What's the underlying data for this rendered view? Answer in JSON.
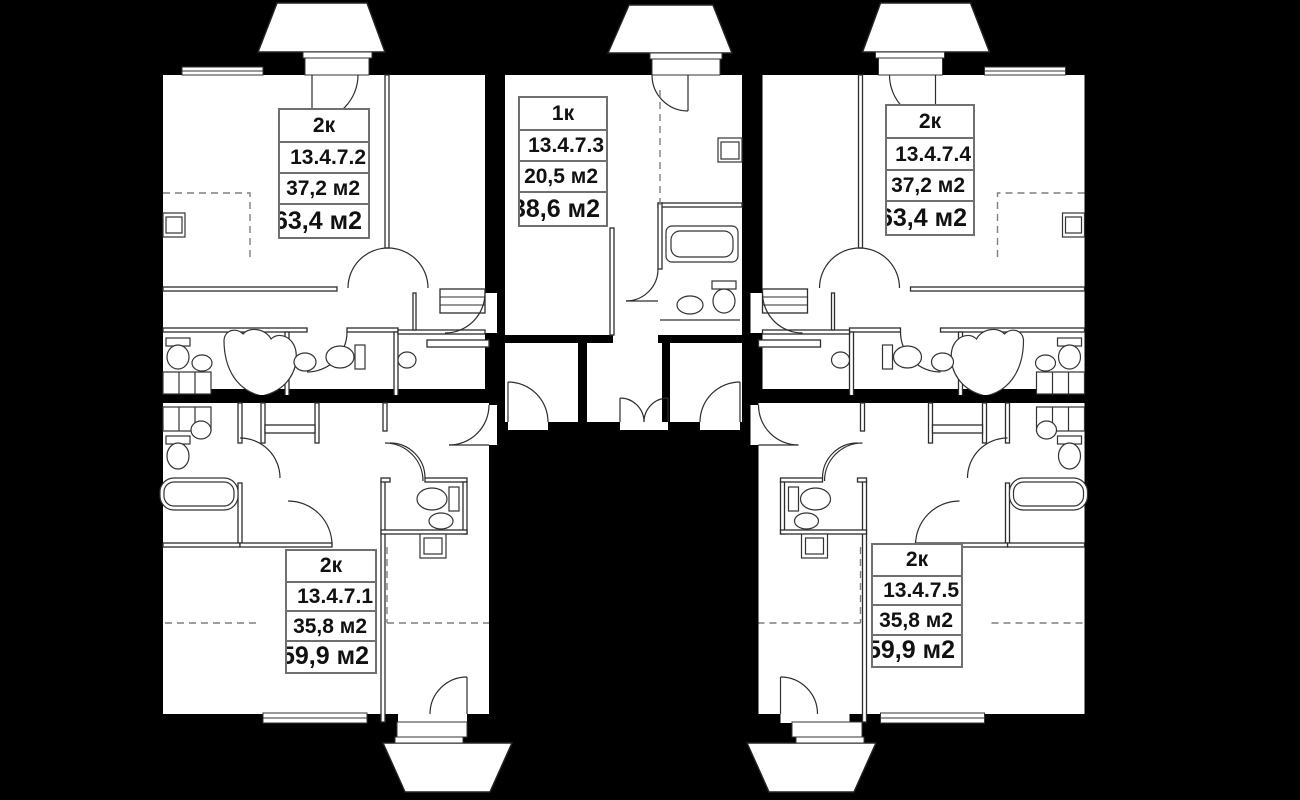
{
  "plan": {
    "colors": {
      "background": "#000000",
      "floor": "#ffffff",
      "line": "#2d2d2d",
      "dashed_line": "#7f7f7f",
      "card_border": "#707070"
    },
    "units": [
      {
        "rooms": "2к",
        "code": "13.4.7.1",
        "area_living": "35,8 м2",
        "area_total": "59,9 м2"
      },
      {
        "rooms": "2к",
        "code": "13.4.7.2",
        "area_living": "37,2 м2",
        "area_total": "63,4 м2"
      },
      {
        "rooms": "1к",
        "code": "13.4.7.3",
        "area_living": "20,5 м2",
        "area_total": "38,6 м2"
      },
      {
        "rooms": "2к",
        "code": "13.4.7.4",
        "area_living": "37,2 м2",
        "area_total": "63,4 м2"
      },
      {
        "rooms": "2к",
        "code": "13.4.7.5",
        "area_living": "35,8 м2",
        "area_total": "59,9 м2"
      }
    ]
  }
}
